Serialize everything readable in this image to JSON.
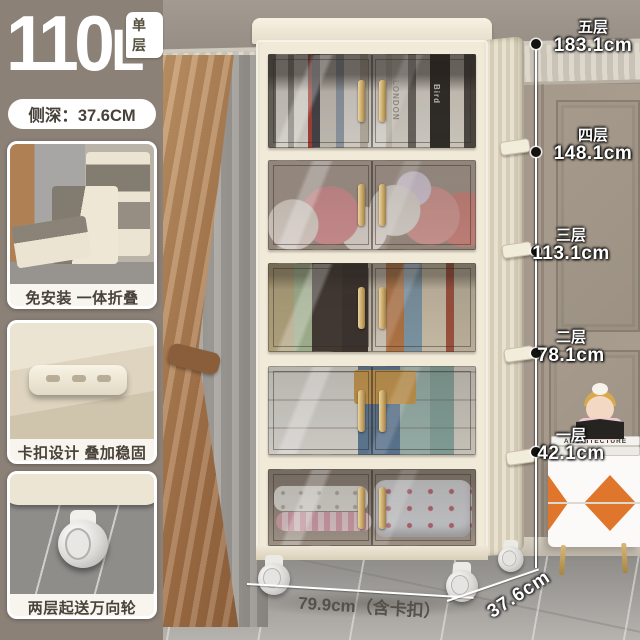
{
  "badge_overlay": {
    "capacity_value": "110",
    "capacity_unit": "L",
    "capacity_tag": "单层",
    "depth_label": "侧深：37.6CM"
  },
  "feature_cards": [
    {
      "caption": "免安装 一体折叠"
    },
    {
      "caption": "卡扣设计 叠加稳固"
    },
    {
      "caption": "两层起送万向轮"
    }
  ],
  "measurements": {
    "tiers": [
      {
        "name": "五层",
        "height": "183.1cm"
      },
      {
        "name": "四层",
        "height": "148.1cm"
      },
      {
        "name": "三层",
        "height": "113.1cm"
      },
      {
        "name": "二层",
        "height": "78.1cm"
      },
      {
        "name": "一层",
        "height": "42.1cm"
      }
    ],
    "width_label": "79.9cm（含卡扣）",
    "depth_label": "37.6cm"
  },
  "scene_text": {
    "book_spine_1": "LONDON",
    "book_spine_2": "Bird",
    "nightstand_book_spine": "ARCHITECTURE"
  },
  "colors": {
    "panel_taupe": "#8b8177",
    "cabinet_cream": "#f1ead9",
    "handle_gold": "#c9a86a",
    "accent_orange": "#e0762b",
    "wall_taupe": "#9a8f84"
  }
}
